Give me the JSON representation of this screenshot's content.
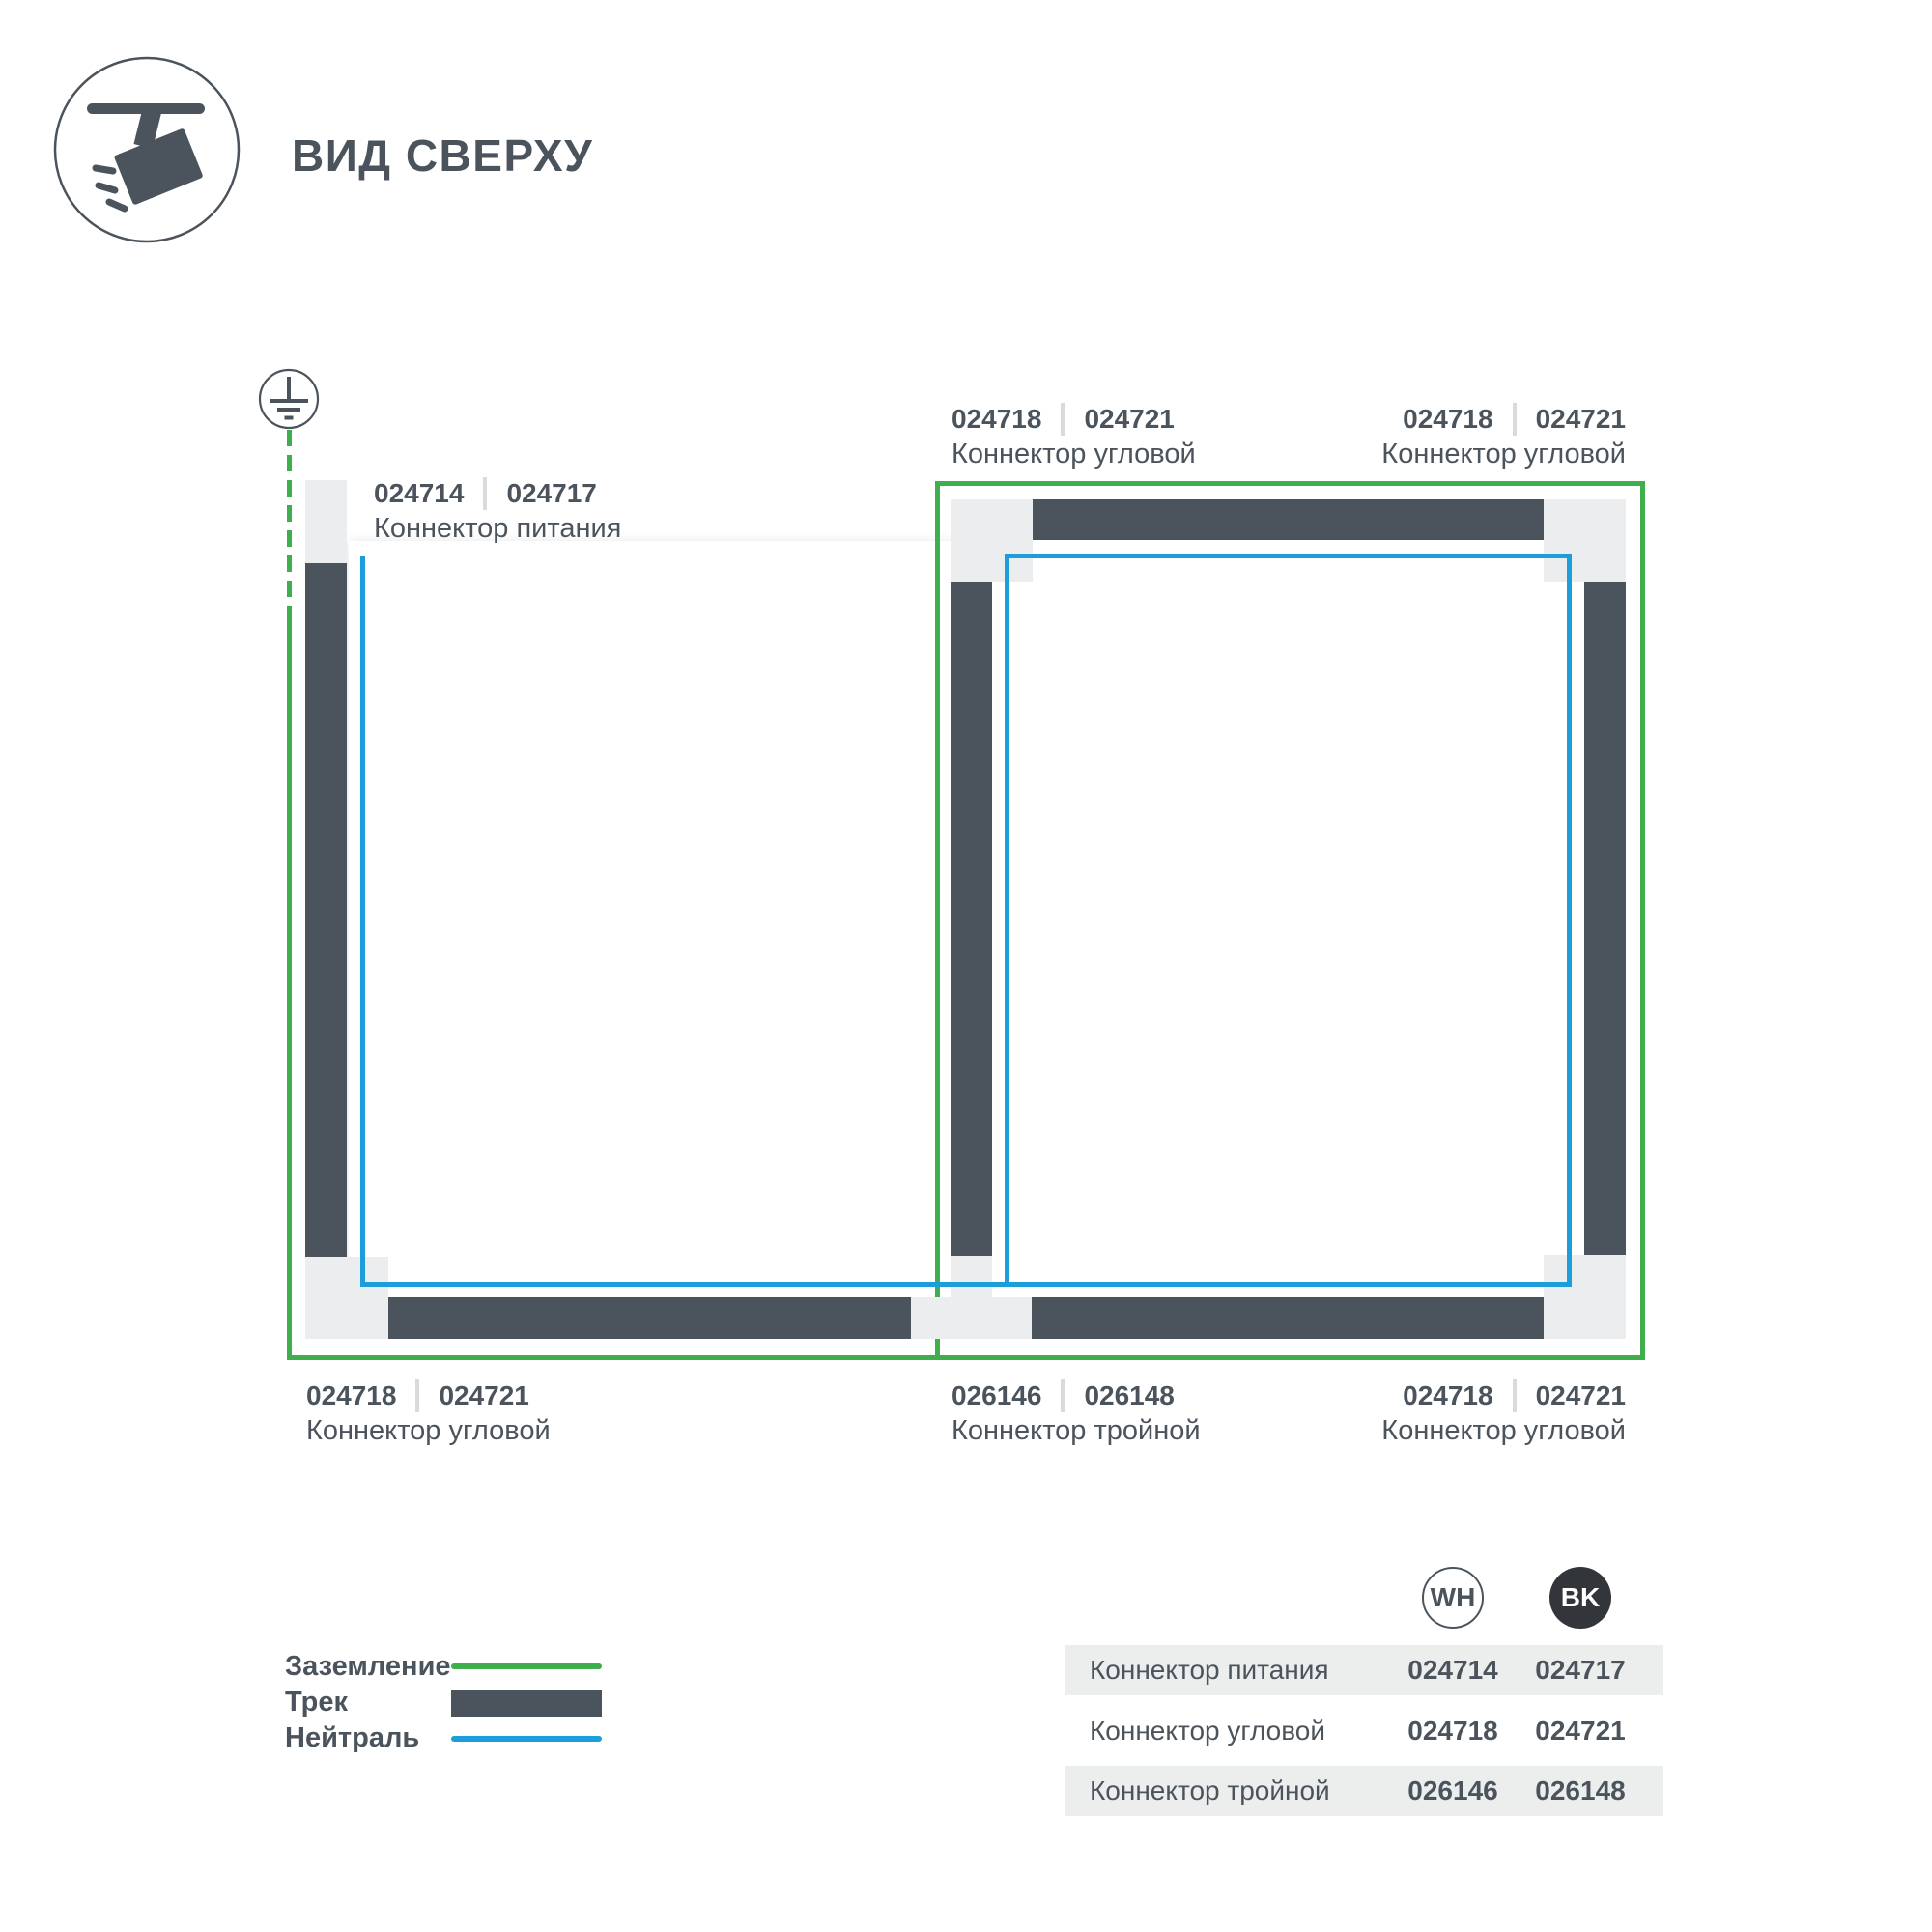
{
  "colors": {
    "ground_green": "#3FAE4D",
    "neutral_blue": "#1B9ED9",
    "track_dark": "#4B545C",
    "track_light": "#ECEDEE",
    "text": "#4B545C",
    "separator": "#D8DBDB",
    "table_row_bg": "#ECEDED",
    "bk_circle": "#32363A"
  },
  "header": {
    "title": "ВИД СВЕРХУ"
  },
  "diagram": {
    "labels": [
      {
        "wh": "024714",
        "bk": "024717",
        "name": "Коннектор питания"
      },
      {
        "wh": "024718",
        "bk": "024721",
        "name": "Коннектор угловой"
      },
      {
        "wh": "024718",
        "bk": "024721",
        "name": "Коннектор угловой"
      },
      {
        "wh": "024718",
        "bk": "024721",
        "name": "Коннектор угловой"
      },
      {
        "wh": "026146",
        "bk": "026148",
        "name": "Коннектор тройной"
      },
      {
        "wh": "024718",
        "bk": "024721",
        "name": "Коннектор угловой"
      }
    ]
  },
  "legend": {
    "items": [
      {
        "label": "Заземление",
        "swatch": "ground-line"
      },
      {
        "label": "Трек",
        "swatch": "track-bar"
      },
      {
        "label": "Нейтраль",
        "swatch": "neutral-line"
      }
    ]
  },
  "table": {
    "columns": [
      {
        "code": "WH"
      },
      {
        "code": "BK"
      }
    ],
    "rows": [
      {
        "name": "Коннектор питания",
        "wh": "024714",
        "bk": "024717"
      },
      {
        "name": "Коннектор угловой",
        "wh": "024718",
        "bk": "024721"
      },
      {
        "name": "Коннектор тройной",
        "wh": "026146",
        "bk": "026148"
      }
    ]
  }
}
